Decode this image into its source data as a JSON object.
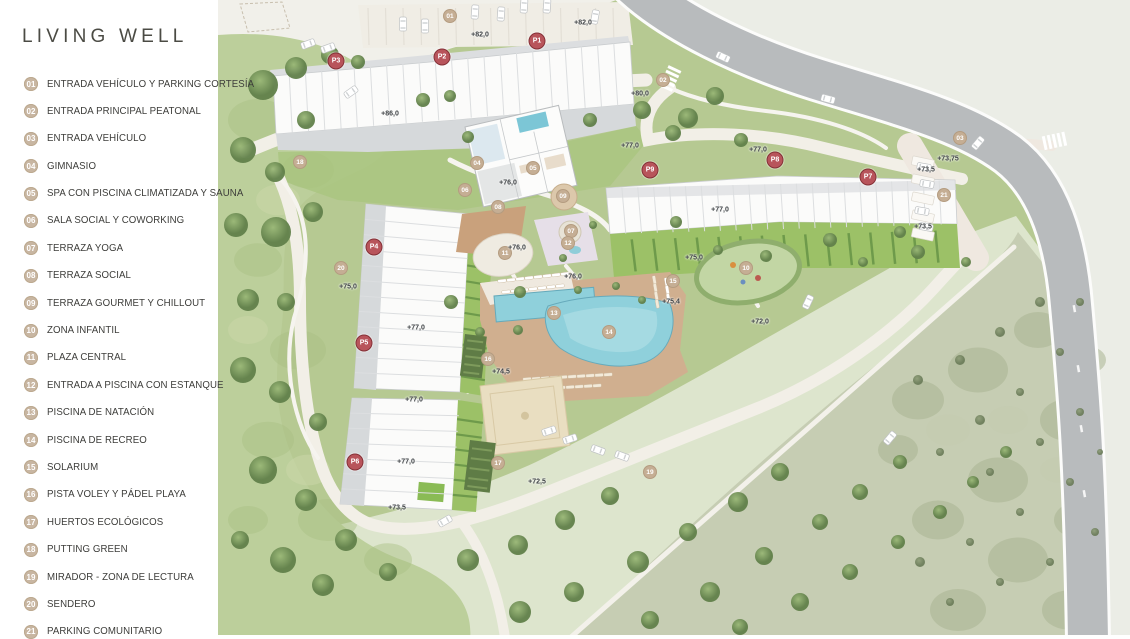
{
  "brand": {
    "title": "LIVING WELL"
  },
  "legend": {
    "items": [
      {
        "num": "01",
        "label": "ENTRADA VEHÍCULO Y PARKING CORTESÍA"
      },
      {
        "num": "02",
        "label": "ENTRADA PRINCIPAL PEATONAL"
      },
      {
        "num": "03",
        "label": "ENTRADA VEHÍCULO"
      },
      {
        "num": "04",
        "label": "GIMNASIO"
      },
      {
        "num": "05",
        "label": "SPA CON PISCINA CLIMATIZADA Y SAUNA"
      },
      {
        "num": "06",
        "label": "SALA SOCIAL Y COWORKING"
      },
      {
        "num": "07",
        "label": "TERRAZA YOGA"
      },
      {
        "num": "08",
        "label": "TERRAZA SOCIAL"
      },
      {
        "num": "09",
        "label": "TERRAZA GOURMET Y CHILLOUT"
      },
      {
        "num": "10",
        "label": "ZONA INFANTIL"
      },
      {
        "num": "11",
        "label": "PLAZA CENTRAL"
      },
      {
        "num": "12",
        "label": "ENTRADA A PISCINA CON ESTANQUE"
      },
      {
        "num": "13",
        "label": "PISCINA DE NATACIÓN"
      },
      {
        "num": "14",
        "label": "PISCINA DE RECREO"
      },
      {
        "num": "15",
        "label": "SOLARIUM"
      },
      {
        "num": "16",
        "label": "PISTA VOLEY Y PÁDEL PLAYA"
      },
      {
        "num": "17",
        "label": "HUERTOS ECOLÓGICOS"
      },
      {
        "num": "18",
        "label": "PUTTING GREEN"
      },
      {
        "num": "19",
        "label": "MIRADOR - ZONA DE LECTURA"
      },
      {
        "num": "20",
        "label": "SENDERO"
      },
      {
        "num": "21",
        "label": "PARKING COMUNITARIO"
      }
    ]
  },
  "map": {
    "p_markers": [
      {
        "label": "P1",
        "x": 319,
        "y": 41
      },
      {
        "label": "P2",
        "x": 224,
        "y": 57
      },
      {
        "label": "P3",
        "x": 118,
        "y": 61
      },
      {
        "label": "P4",
        "x": 156,
        "y": 247
      },
      {
        "label": "P5",
        "x": 146,
        "y": 343
      },
      {
        "label": "P6",
        "x": 137,
        "y": 462
      },
      {
        "label": "P7",
        "x": 650,
        "y": 177
      },
      {
        "label": "P8",
        "x": 557,
        "y": 160
      },
      {
        "label": "P9",
        "x": 432,
        "y": 170
      }
    ],
    "amenity_markers": [
      {
        "num": "01",
        "x": 232,
        "y": 16
      },
      {
        "num": "02",
        "x": 445,
        "y": 80
      },
      {
        "num": "03",
        "x": 742,
        "y": 138
      },
      {
        "num": "04",
        "x": 259,
        "y": 163
      },
      {
        "num": "05",
        "x": 315,
        "y": 168
      },
      {
        "num": "06",
        "x": 247,
        "y": 190
      },
      {
        "num": "07",
        "x": 353,
        "y": 231
      },
      {
        "num": "08",
        "x": 280,
        "y": 207
      },
      {
        "num": "09",
        "x": 345,
        "y": 196
      },
      {
        "num": "10",
        "x": 528,
        "y": 268
      },
      {
        "num": "11",
        "x": 287,
        "y": 253
      },
      {
        "num": "12",
        "x": 350,
        "y": 243
      },
      {
        "num": "13",
        "x": 336,
        "y": 313
      },
      {
        "num": "14",
        "x": 391,
        "y": 332
      },
      {
        "num": "15",
        "x": 455,
        "y": 281
      },
      {
        "num": "16",
        "x": 270,
        "y": 359
      },
      {
        "num": "17",
        "x": 280,
        "y": 463
      },
      {
        "num": "18",
        "x": 82,
        "y": 162
      },
      {
        "num": "19",
        "x": 432,
        "y": 472
      },
      {
        "num": "20",
        "x": 123,
        "y": 268
      },
      {
        "num": "21",
        "x": 726,
        "y": 195
      }
    ],
    "elevation_labels": [
      {
        "text": "+82,0",
        "x": 262,
        "y": 35
      },
      {
        "text": "+82,0",
        "x": 365,
        "y": 23
      },
      {
        "text": "+86,0",
        "x": 172,
        "y": 114
      },
      {
        "text": "+80,0",
        "x": 422,
        "y": 94
      },
      {
        "text": "+77,0",
        "x": 412,
        "y": 146
      },
      {
        "text": "+77,0",
        "x": 540,
        "y": 150
      },
      {
        "text": "+77,0",
        "x": 502,
        "y": 210
      },
      {
        "text": "+77,0",
        "x": 198,
        "y": 328
      },
      {
        "text": "+77,0",
        "x": 196,
        "y": 400
      },
      {
        "text": "+77,0",
        "x": 188,
        "y": 462
      },
      {
        "text": "+76,0",
        "x": 290,
        "y": 183
      },
      {
        "text": "+76,0",
        "x": 299,
        "y": 248
      },
      {
        "text": "+76,0",
        "x": 355,
        "y": 277
      },
      {
        "text": "+75,0",
        "x": 476,
        "y": 258
      },
      {
        "text": "+75,0",
        "x": 130,
        "y": 287
      },
      {
        "text": "+75,4",
        "x": 453,
        "y": 302
      },
      {
        "text": "+74,5",
        "x": 283,
        "y": 372
      },
      {
        "text": "+73,75",
        "x": 730,
        "y": 159
      },
      {
        "text": "+73,5",
        "x": 708,
        "y": 170
      },
      {
        "text": "+73,5",
        "x": 705,
        "y": 227
      },
      {
        "text": "+73,5",
        "x": 179,
        "y": 508
      },
      {
        "text": "+72,0",
        "x": 542,
        "y": 322
      },
      {
        "text": "+72,5",
        "x": 319,
        "y": 482
      }
    ]
  },
  "colors": {
    "p_marker_red": "#b8545b",
    "amenity_marker_tan": "#c5ae94",
    "legend_circle_tan": "#c8b6a2",
    "pool_blue": "#8fd0db",
    "lawn_bright": "#9cc167",
    "road_gray": "#b8bbbd"
  }
}
